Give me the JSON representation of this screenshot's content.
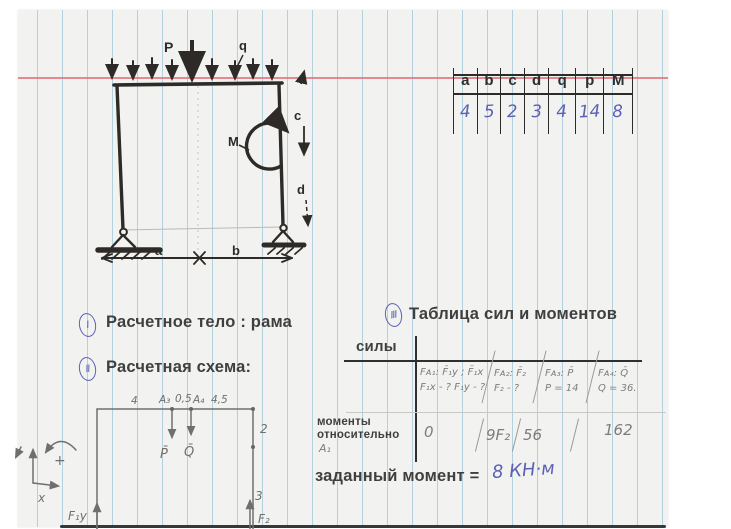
{
  "colors": {
    "paper": "#f2f3f0",
    "ruling_blue": "#80b3cf",
    "ruling_red": "#e4747e",
    "ink_blue": "#5d61b4",
    "pencil_gray": "#7d7d7d",
    "pen_black": "#2e2a27",
    "printed_text": "#3f3f3f"
  },
  "params_table": {
    "headers": [
      "a",
      "b",
      "c",
      "d",
      "q",
      "p",
      "M"
    ],
    "values": [
      "4",
      "5",
      "2",
      "3",
      "4",
      "14",
      "8"
    ]
  },
  "sections": {
    "s1": {
      "num": "I",
      "label": "Расчетное тело : рама"
    },
    "s2": {
      "num": "II",
      "label": "Расчетная схема:"
    },
    "s3": {
      "num": "III",
      "label": "Таблица сил и моментов"
    }
  },
  "forces_table": {
    "forces_label": "силы",
    "col1": {
      "line1": "Fᴀ₁: F̄₁y ; F̄₁x",
      "line2": "F₁x - ?  F₁y - ?"
    },
    "col2": {
      "line1": "Fᴀ₂: F̄₂",
      "line2": "F₂ - ?"
    },
    "col3": {
      "line1": "Fᴀ₃: P̄",
      "line2": "P = 14"
    },
    "col4": {
      "line1": "Fᴀ₄: Q̄",
      "line2": "Q = 36."
    },
    "moments_label_line1": "моменты",
    "moments_label_line2": "относительно",
    "moments_label_line3": "A₁",
    "moments": [
      "0",
      "9F₂",
      "56",
      "162"
    ]
  },
  "given_moment": {
    "label": "заданный момент =",
    "value": "8 КН·м"
  },
  "frame_sketch": {
    "force_p": "P",
    "load_q": "q",
    "moment_m": "M",
    "dim_a": "a",
    "dim_b": "b",
    "dim_c": "c",
    "dim_d": "d"
  },
  "scheme": {
    "dim_left": "4",
    "point_a3": "A₃",
    "dim_mid": "0,5",
    "point_a4": "A₄",
    "dim_right": "4,5",
    "force_p": "P̄",
    "force_q": "Q̄",
    "dim_col_upper": "2",
    "dim_col_lower": "3",
    "reaction_f1y": "F₁y",
    "reaction_f2": "F₂",
    "axis_x": "x",
    "rotation_sign": "+"
  }
}
